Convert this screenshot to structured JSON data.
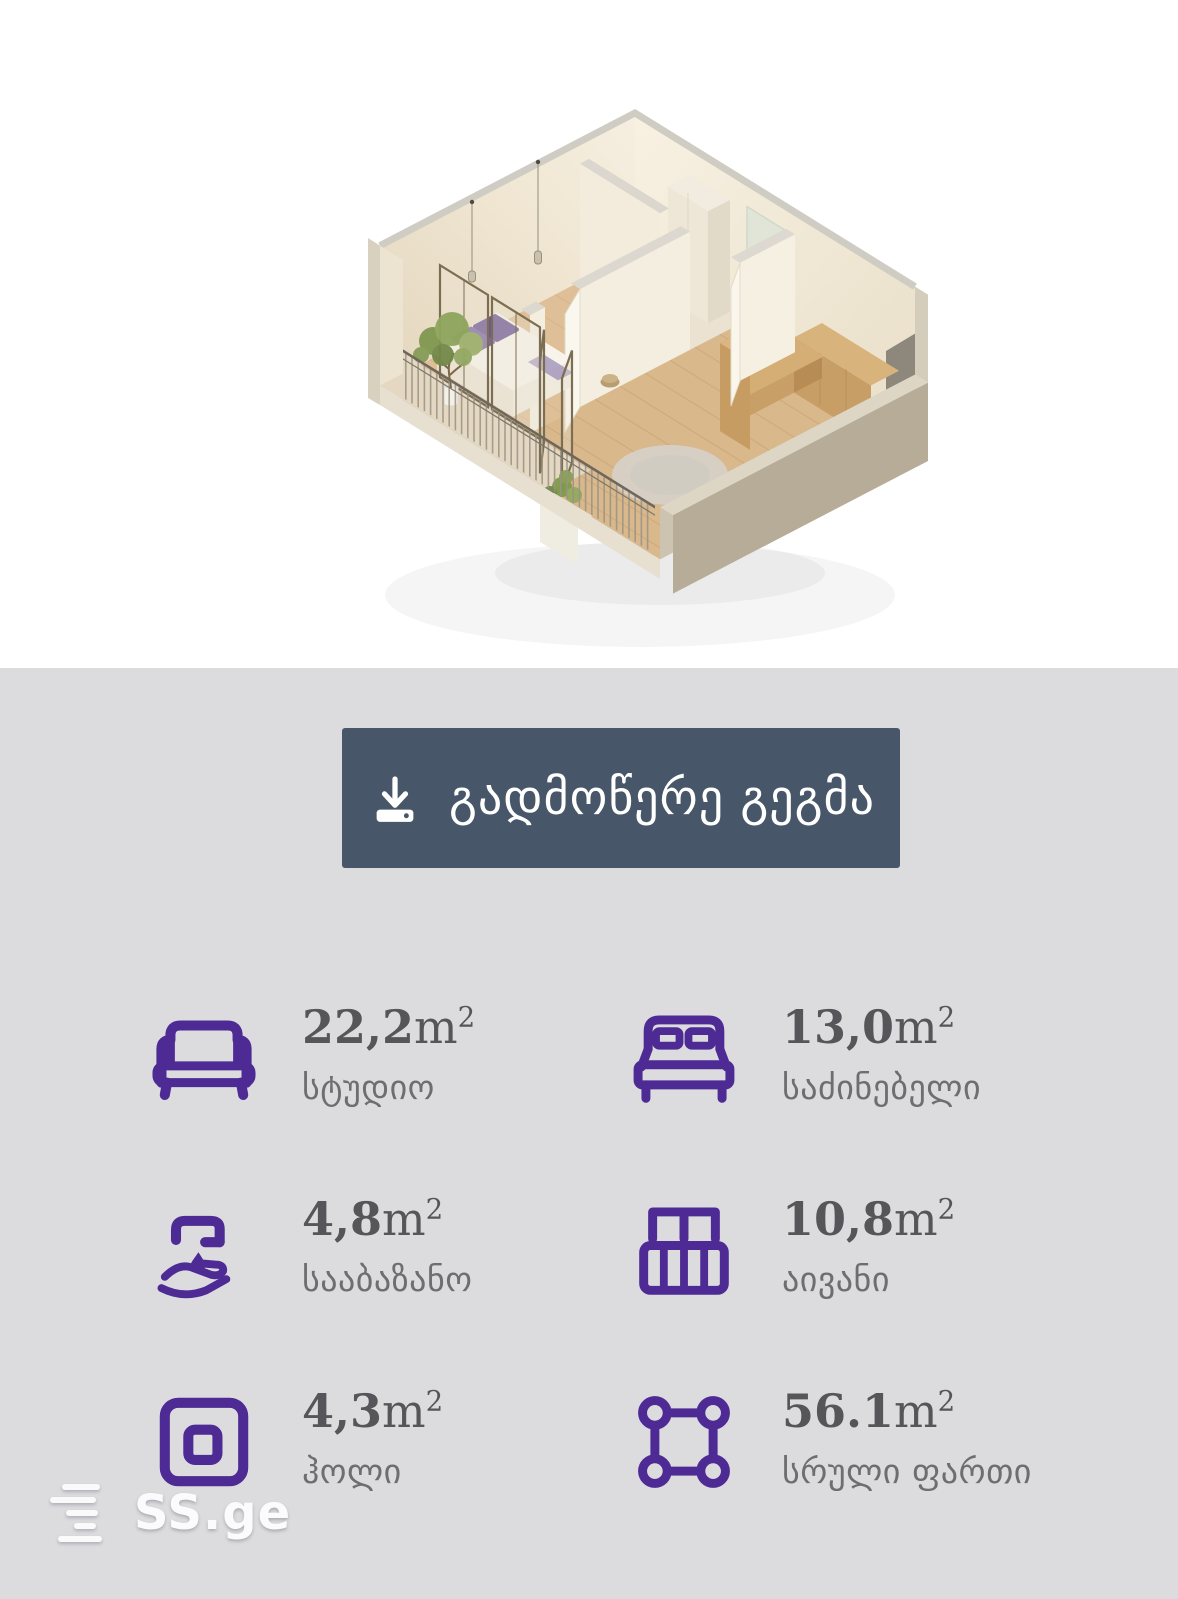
{
  "download_button": {
    "label": "გადმოწერე გეგმა",
    "icon": "download-icon",
    "bg_color": "#475769"
  },
  "stats": [
    {
      "icon": "sofa-icon",
      "value": "22,2",
      "unit": "m",
      "sup": "2",
      "label": "სტუდიო"
    },
    {
      "icon": "bed-icon",
      "value": "13,0",
      "unit": "m",
      "sup": "2",
      "label": "საძინებელი"
    },
    {
      "icon": "faucet-hand-icon",
      "value": "4,8",
      "unit": "m",
      "sup": "2",
      "label": "სააბაზანო"
    },
    {
      "icon": "balcony-icon",
      "value": "10,8",
      "unit": "m",
      "sup": "2",
      "label": "აივანი"
    },
    {
      "icon": "hall-icon",
      "value": "4,3",
      "unit": "m",
      "sup": "2",
      "label": "ჰოლი"
    },
    {
      "icon": "area-icon",
      "value": "56.1",
      "unit": "m",
      "sup": "2",
      "label": "სრული ფართი"
    }
  ],
  "watermark": {
    "text": "SS.ge",
    "icon": "ssge-logo-icon"
  },
  "floor_plan": {
    "description_icon": "floor-plan-3d-render"
  },
  "colors": {
    "section_bg": "#dcdcdf",
    "button_bg": "#475769",
    "accent_purple": "#4e2a94",
    "value_text": "#56565a",
    "label_text": "#6e6e72"
  }
}
